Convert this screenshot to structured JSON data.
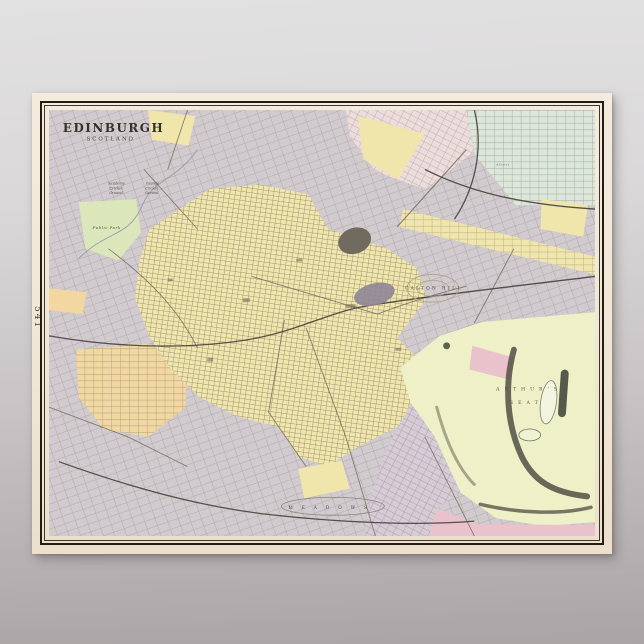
{
  "page": {
    "margin_number": "541"
  },
  "poster": {
    "title": "EDINBURGH",
    "subtitle": "SCOTLAND",
    "labels": {
      "academy_cricket": {
        "line1": "Academy",
        "line2": "Cricket",
        "line3": "Ground"
      },
      "grange_cricket": {
        "line1": "Grange",
        "line2": "Cricket",
        "line3": "Ground"
      },
      "public_park": "Public Park",
      "calton_hill": "CALTON HILL",
      "arthurs_seat_line1": "ARTHUR'S",
      "arthurs_seat_line2": "SEAT",
      "meadows": "MEADOWS",
      "albert_street": "Albert"
    },
    "colors": {
      "map_base": "#d1cacf",
      "district_yellow": "#f0e5ab",
      "holyrood_green": "#eef0c8",
      "lawn_green": "#dce6bb",
      "district_orange": "#f2d8a0",
      "district_lavender": "#d6cbd7",
      "pink_tint": "#ecdcdc",
      "teal_tint": "#dbe7db",
      "accent_pink": "#e9c2cb"
    }
  }
}
